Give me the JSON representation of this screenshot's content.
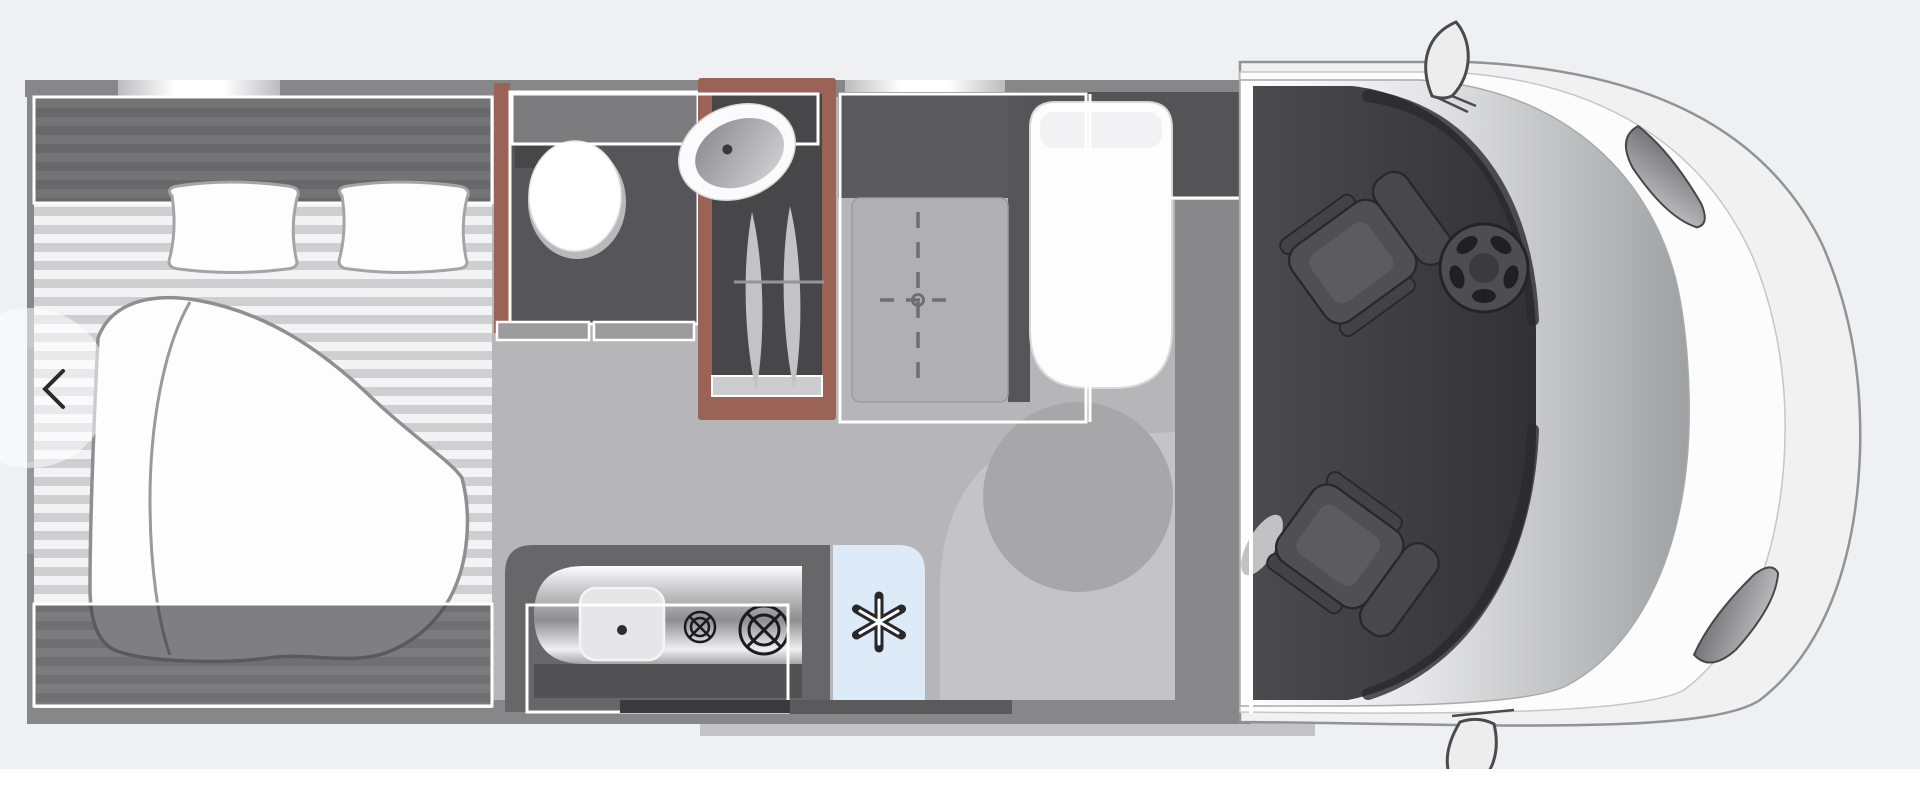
{
  "page": {
    "background": "#eef0f1",
    "footer_strip_color": "#ffffff"
  },
  "carousel": {
    "prev_button": {
      "name": "chevron-left",
      "glyph": "‹"
    }
  },
  "floorplan": {
    "type": "motorhome-top-view-floorplan",
    "vehicle_front": "right",
    "rooms": [
      {
        "id": "rear-bedroom",
        "features": [
          "double-bed",
          "two-pillows",
          "duvet",
          "headboard-shelf"
        ]
      },
      {
        "id": "bathroom",
        "features": [
          "toilet",
          "washbasin",
          "overhead-cabinet"
        ]
      },
      {
        "id": "shower",
        "features": [
          "folding-glass-doors",
          "wood-trim-frame"
        ]
      },
      {
        "id": "dinette",
        "features": [
          "height-adjustable-table",
          "bench-seat",
          "swivel-floor-circle"
        ]
      },
      {
        "id": "kitchen",
        "features": [
          "sink",
          "two-burner-hob",
          "steel-worktop"
        ]
      },
      {
        "id": "fridge",
        "features": [
          "snowflake-symbol"
        ]
      },
      {
        "id": "cab",
        "features": [
          "steering-wheel",
          "two-swivel-seats",
          "windscreen",
          "wing-mirrors",
          "headlights"
        ]
      }
    ],
    "icons": [
      {
        "name": "snowflake-icon",
        "represents": "refrigerator"
      },
      {
        "name": "burner-icon",
        "represents": "gas-hob-ring"
      },
      {
        "name": "steering-wheel-icon",
        "represents": "driver-position"
      },
      {
        "name": "table-centerline-icon",
        "represents": "adjustable-table"
      },
      {
        "name": "chevron-left-icon",
        "represents": "previous-image"
      }
    ],
    "colors": {
      "wall": "#87878a",
      "floor": "#b6b6b9",
      "floor_light": "#c4c4c7",
      "cab_dark": "#3f3f43",
      "wood_trim": "#9b6355",
      "fridge_blue": "#dcebf7",
      "room_dark": "#56565a",
      "band_dark": "#5a5a5d",
      "counter_dark": "#67676a",
      "table_gray": "#b0b0b3",
      "seat_white": "#fdfdfe",
      "outline_white": "#ffffff",
      "swivel_gray": "#a7a7aa",
      "body_light": "#f1f1f2"
    }
  }
}
